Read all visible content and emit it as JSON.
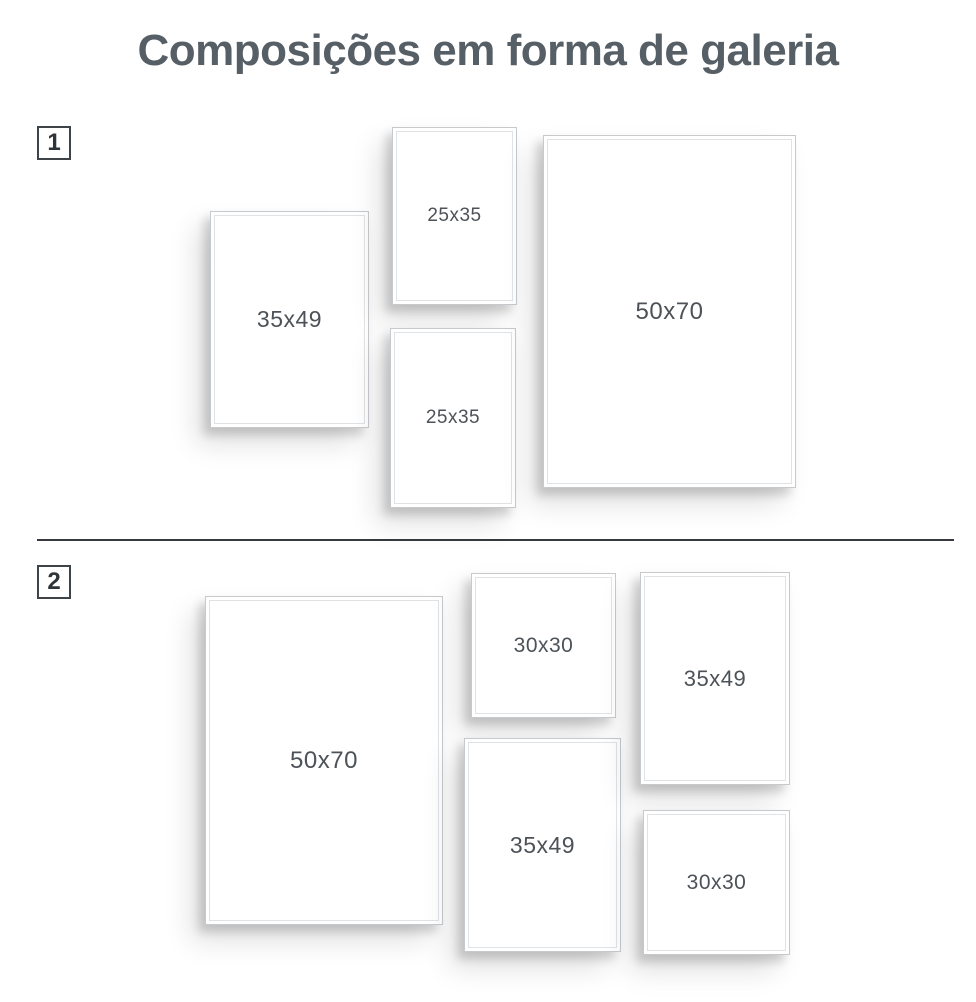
{
  "title": "Composições em forma de galeria",
  "colors": {
    "background": "#ffffff",
    "title": "#565e66",
    "frame_label": "#4c5257",
    "frame_border": "#c6cacd",
    "frame_mat_line": "#e0e3e5",
    "divider": "#36393d",
    "badge_border": "#3e4347",
    "badge_text": "#2f3438"
  },
  "sections": [
    {
      "number": "1",
      "frames": [
        {
          "label": "35x49",
          "x": 210,
          "y": 211,
          "w": 159,
          "h": 217
        },
        {
          "label": "25x35",
          "x": 392,
          "y": 127,
          "w": 125,
          "h": 178
        },
        {
          "label": "25x35",
          "x": 390,
          "y": 328,
          "w": 126,
          "h": 180
        },
        {
          "label": "50x70",
          "x": 543,
          "y": 135,
          "w": 253,
          "h": 353
        }
      ]
    },
    {
      "number": "2",
      "frames": [
        {
          "label": "50x70",
          "x": 205,
          "y": 596,
          "w": 238,
          "h": 329
        },
        {
          "label": "30x30",
          "x": 471,
          "y": 573,
          "w": 145,
          "h": 145
        },
        {
          "label": "35x49",
          "x": 464,
          "y": 738,
          "w": 157,
          "h": 214
        },
        {
          "label": "35x49",
          "x": 640,
          "y": 572,
          "w": 150,
          "h": 213
        },
        {
          "label": "30x30",
          "x": 643,
          "y": 810,
          "w": 147,
          "h": 145
        }
      ]
    }
  ]
}
